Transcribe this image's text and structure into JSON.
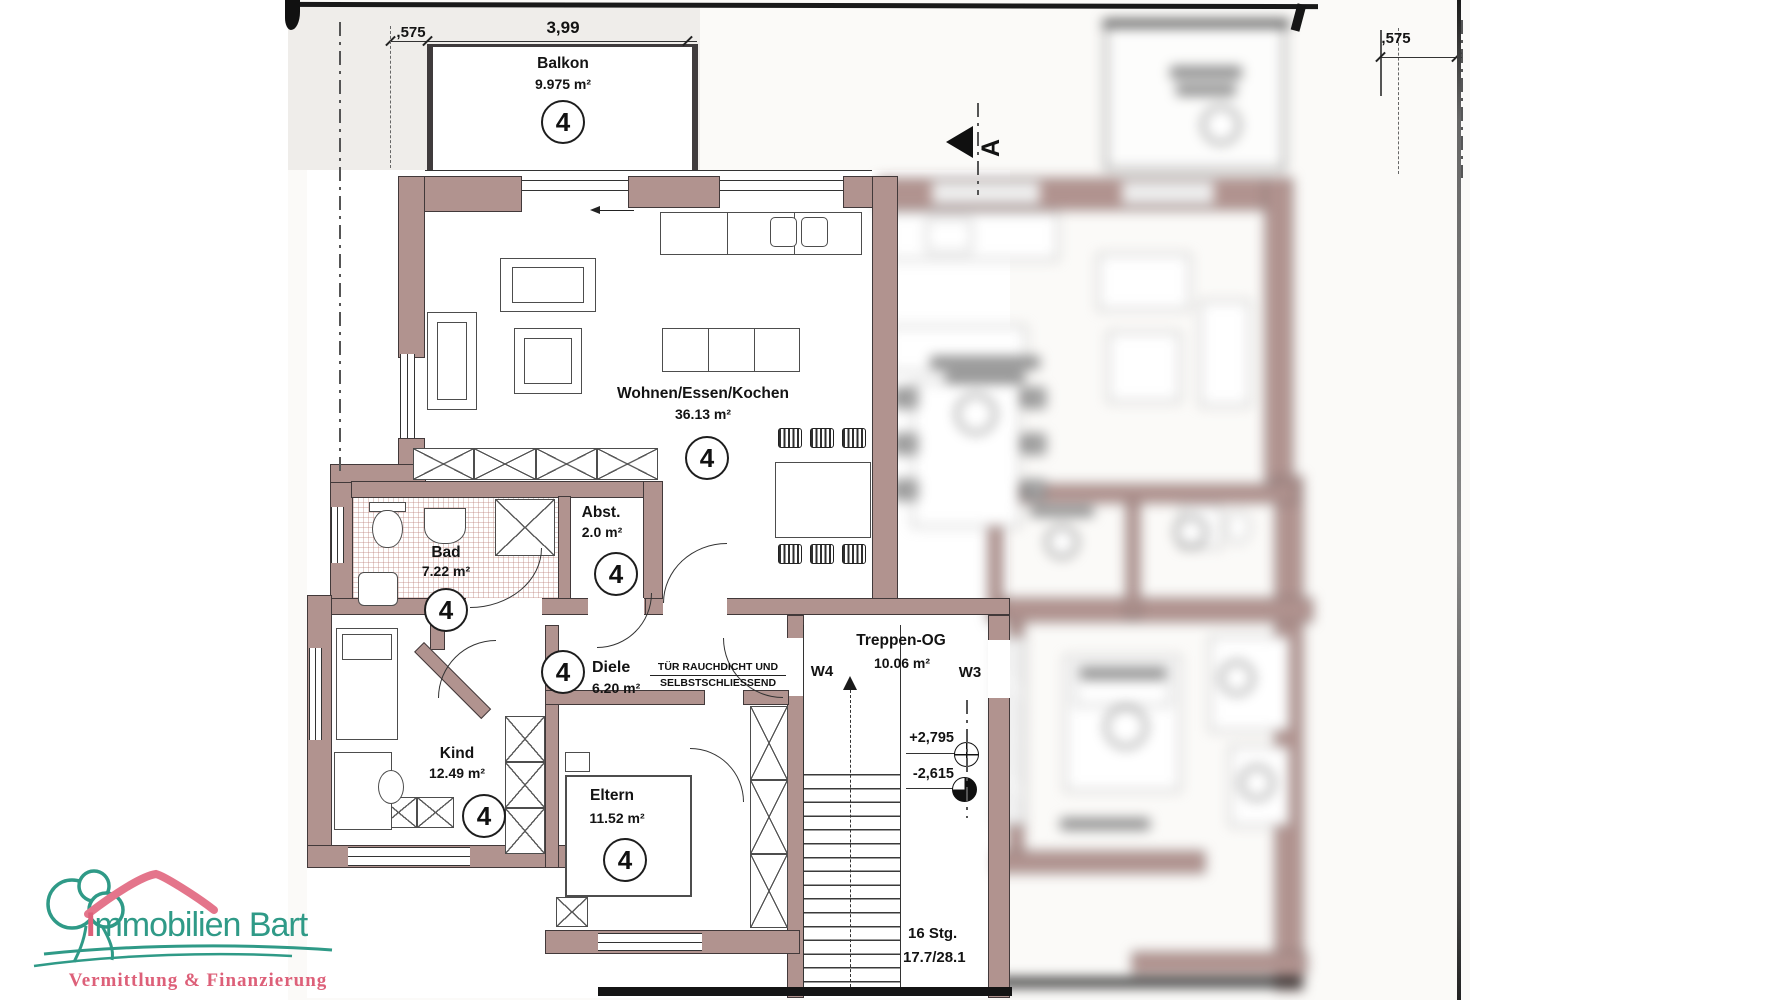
{
  "plan": {
    "rooms": [
      {
        "id": "balkon",
        "name": "Balkon",
        "area": "9.975 m²",
        "unit": "4"
      },
      {
        "id": "wohnen",
        "name": "Wohnen/Essen/Kochen",
        "area": "36.13 m²",
        "unit": "4"
      },
      {
        "id": "bad",
        "name": "Bad",
        "area": "7.22 m²",
        "unit": "4"
      },
      {
        "id": "abstellraum",
        "name": "Abst.",
        "area": "2.0 m²",
        "unit": "4"
      },
      {
        "id": "diele",
        "name": "Diele",
        "area": "6.20 m²",
        "unit": "4"
      },
      {
        "id": "kind",
        "name": "Kind",
        "area": "12.49 m²",
        "unit": "4"
      },
      {
        "id": "eltern",
        "name": "Eltern",
        "area": "11.52 m²",
        "unit": "4"
      },
      {
        "id": "treppenhaus",
        "name": "Treppen-OG",
        "area": "10.06 m²"
      }
    ],
    "dimensions": {
      "left_offset": ",575",
      "balcony_width": "3,99",
      "right_offset": ",575"
    },
    "doors": {
      "w4": "W4",
      "w3": "W3"
    },
    "levels": {
      "upper": "+2,795",
      "lower": "-2,615"
    },
    "stairs": {
      "line1": "16 Stg.",
      "line2": "17.7/28.1"
    },
    "door_note": {
      "line1": "TÜR RAUCHDICHT UND",
      "line2": "SELBSTSCHLIESSEND"
    },
    "section_marker": "A"
  },
  "logo": {
    "title": "Immobilien Bart",
    "subtitle": "Vermittlung & Finanzierung"
  },
  "colors": {
    "wall": "#b1938f",
    "teal": "#2f9a87",
    "pink": "#dd6079"
  }
}
